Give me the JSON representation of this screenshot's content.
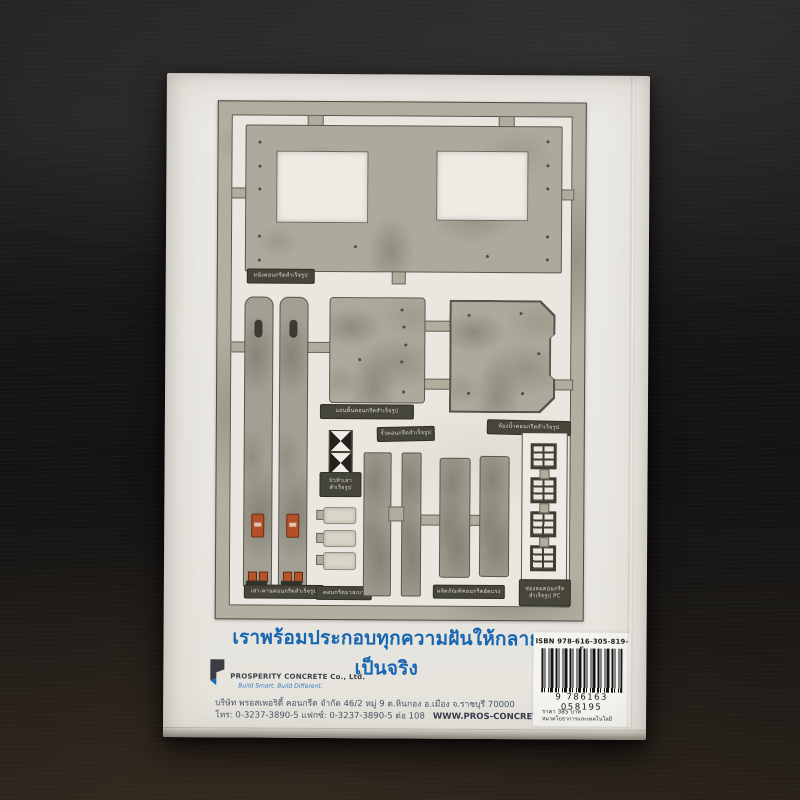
{
  "book": {
    "headline": "เราพร้อมประกอบทุกความฝันให้กลายเป็นจริง",
    "publisher": {
      "company": "PROSPERITY CONCRETE Co., Ltd.",
      "tagline": "Build Smart, Build Different.",
      "address_line": "บริษัท พรอสเพอริตี้ คอนกรีต จำกัด 46/2 หมู่ 9 ต.หินกอง อ.เมือง จ.ราชบุรี 70000",
      "phone_line": "โทร: 0-3237-3890-5 แฟกซ์: 0-3237-3890-5 ต่อ 108",
      "website": "WWW.PROS-CONCRETE.COM"
    },
    "isbn": {
      "label": "ISBN 978-616-305-819-5",
      "barcode_digits": "9 786163 058195",
      "price": "ราคา 385 บาท",
      "category": "หมวดโยธาการและเทคโนโลยี"
    },
    "diagram": {
      "labels": {
        "wall": "ผนังคอนกรีตสำเร็จรูป",
        "floor_plank": "แผ่นพื้นคอนกรีตสำเร็จรูป",
        "fence": "รั้วคอนกรีตสำเร็จรูป",
        "bathroom": "ห้องน้ำคอนกรีตสำเร็จรูป",
        "column_cap": "บัวหัวเสา\nสำเร็จรูป",
        "column_beam": "เสา-คานคอนกรีตสำเร็จรูป",
        "lightweight": "คอนกรีตมวลเบา",
        "prestressed": "ผลิตภัณฑ์คอนกรีตอัดแรง",
        "vent_block": "ช่องลมคอนกรีต\nสำเร็จรูป PC"
      }
    }
  },
  "colors": {
    "headline_blue": "#1565b2",
    "logo_blue": "#1f6cb4",
    "accent_orange": "#b35029",
    "cover_white": "#e9e7e1",
    "concrete_gray": "#adaa9d",
    "wood_dark": "#181716"
  }
}
